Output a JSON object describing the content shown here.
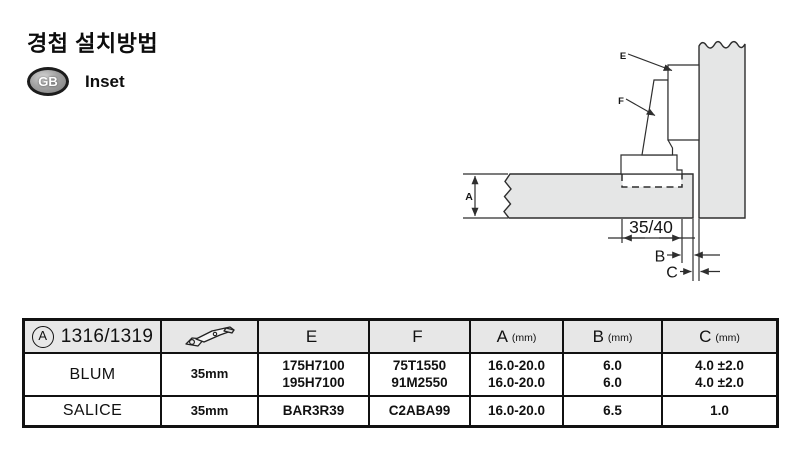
{
  "header": {
    "title": "경첩 설치방법",
    "badge_text": "GB",
    "badge_label": "Inset"
  },
  "diagram": {
    "dim_width": "35/40",
    "label_a": "A",
    "label_b": "B",
    "label_c": "C",
    "label_e": "E",
    "label_f": "F"
  },
  "table": {
    "ref": {
      "circle_letter": "A",
      "code": "1316/1319"
    },
    "icon": "hinge-icon",
    "columns": [
      {
        "letter": "E",
        "unit": ""
      },
      {
        "letter": "F",
        "unit": ""
      },
      {
        "letter": "A",
        "unit": "(mm)"
      },
      {
        "letter": "B",
        "unit": "(mm)"
      },
      {
        "letter": "C",
        "unit": "(mm)"
      }
    ],
    "rows": [
      {
        "brand": "BLUM",
        "cup": "35mm",
        "e": [
          "175H7100",
          "195H7100"
        ],
        "f": [
          "75T1550",
          "91M2550"
        ],
        "a": [
          "16.0-20.0",
          "16.0-20.0"
        ],
        "b": [
          "6.0",
          "6.0"
        ],
        "c": [
          "4.0 ±2.0",
          "4.0 ±2.0"
        ]
      },
      {
        "brand": "SALICE",
        "cup": "35mm",
        "e": [
          "BAR3R39"
        ],
        "f": [
          "C2ABA99"
        ],
        "a": [
          "16.0-20.0"
        ],
        "b": [
          "6.5"
        ],
        "c": [
          "1.0"
        ]
      }
    ]
  },
  "colors": {
    "panel_fill": "#e5e6e6",
    "line": "#2e2e2e",
    "table_header_bg": "#e7e7e7",
    "border": "#111111"
  }
}
